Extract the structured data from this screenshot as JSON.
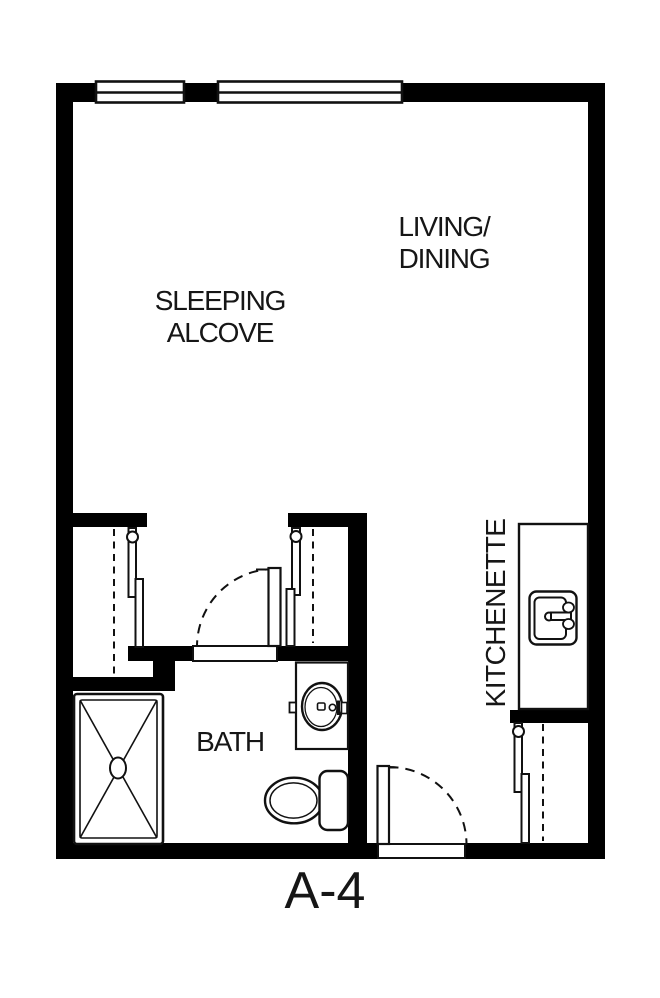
{
  "floor_plan": {
    "unit_label": "A-4",
    "labels": {
      "living_line1": "LIVING/",
      "living_line2": "DINING",
      "sleeping_line1": "SLEEPING",
      "sleeping_line2": "ALCOVE",
      "bath": "BATH",
      "kitchenette": "KITCHENETTE"
    },
    "colors": {
      "wall": "#000000",
      "line": "#111111",
      "text": "#161616",
      "background": "#ffffff"
    }
  }
}
